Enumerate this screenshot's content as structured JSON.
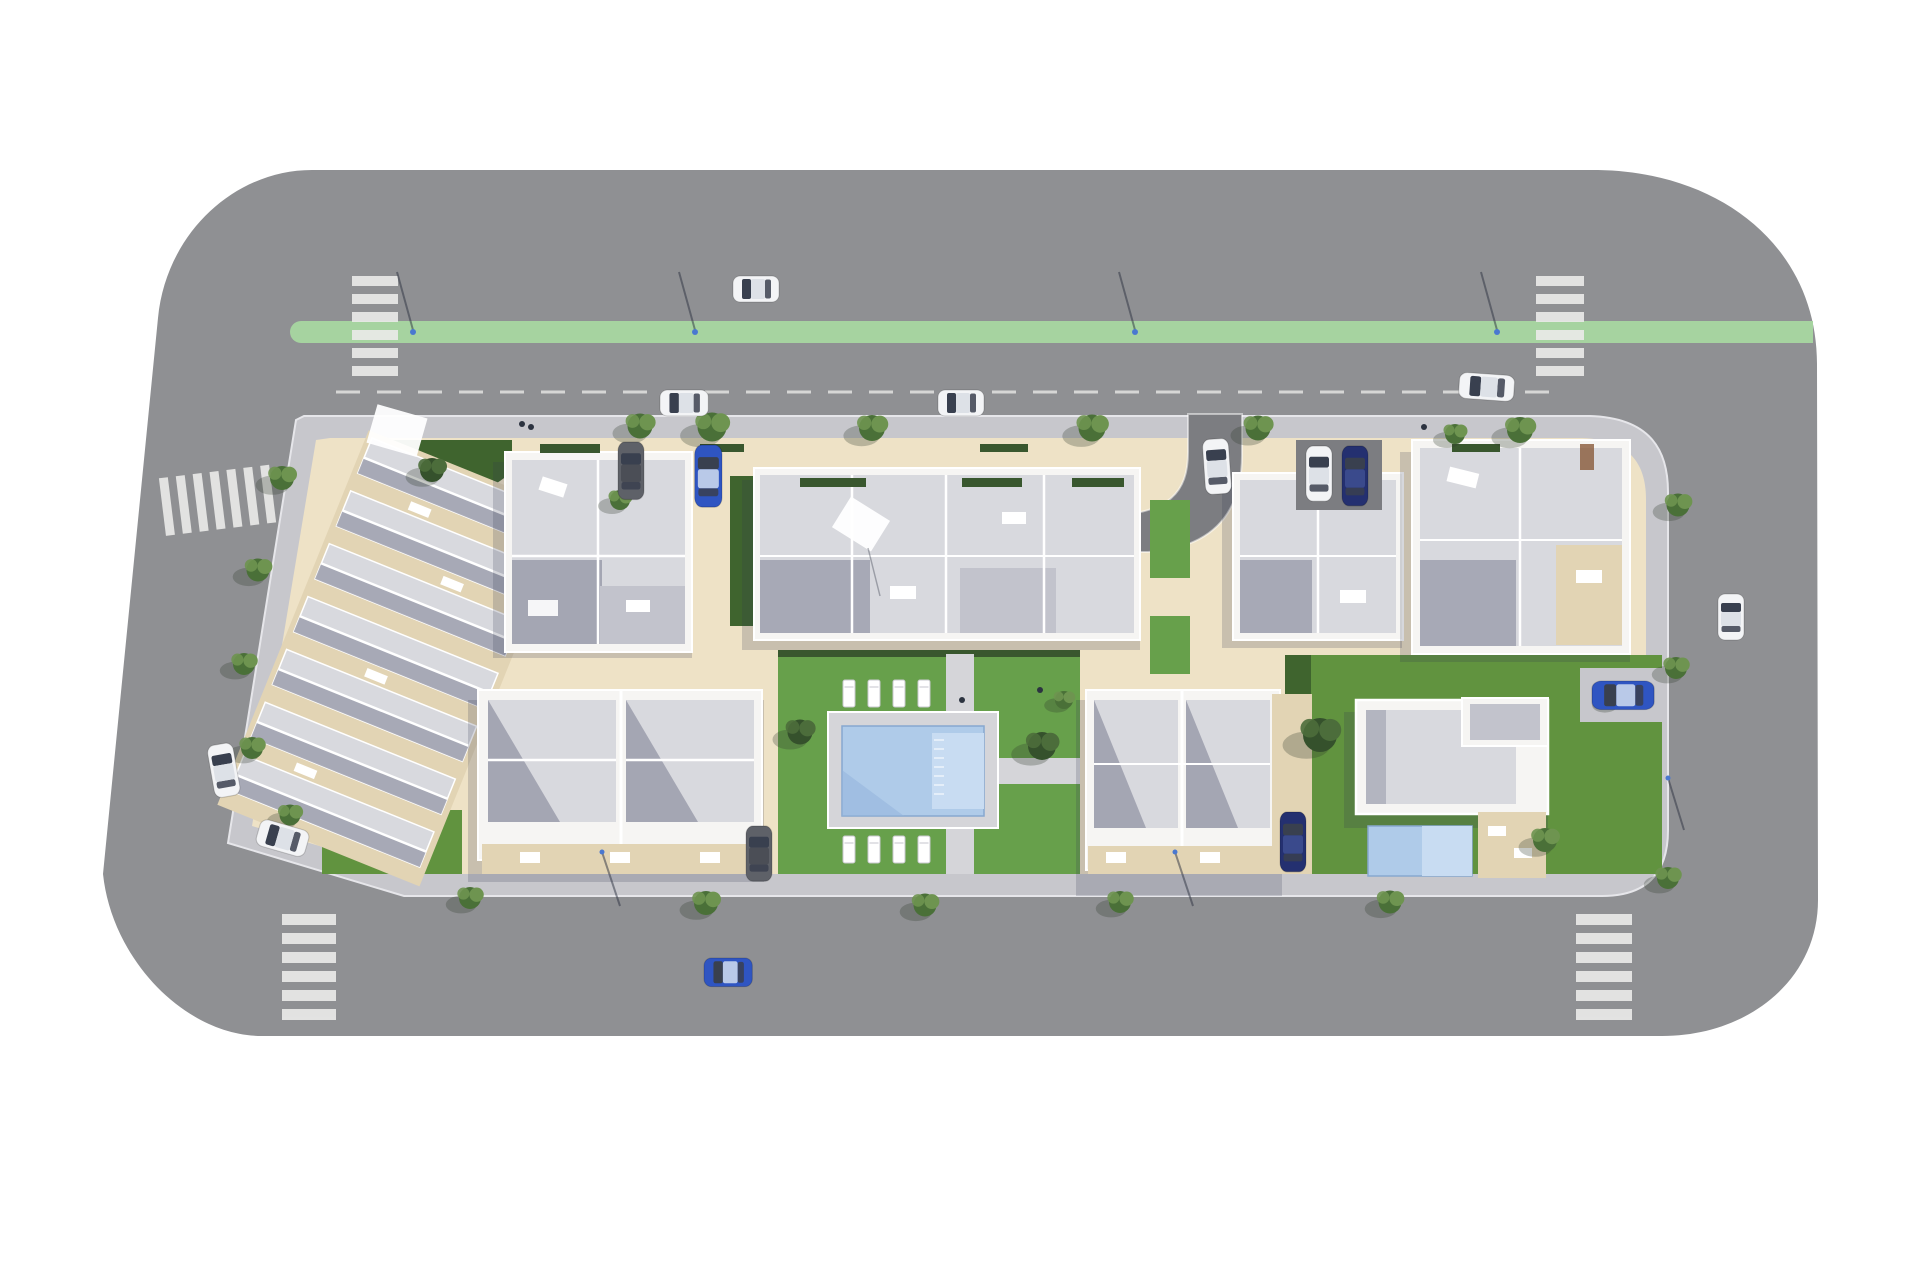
{
  "scene": {
    "description": "Aerial top-down 3D architectural render of a residential development block: white apartment buildings and townhouses with grey roof terraces around a central lawn courtyard with communal swimming pool, surrounded by asphalt streets with a green bike lane, zebra crosswalks, street trees and parked cars, on a white background",
    "view": "bird's-eye site plan",
    "background": "white"
  },
  "palette": {
    "bg": "#ffffff",
    "road": "#8f9093",
    "road_dark": "#7c7d81",
    "green_lane": "#a6d3a0",
    "crosswalk": "#eaeae8",
    "sidewalk": "#c7c7cc",
    "pavement": "#eee2c6",
    "pavement_shade": "#e2d4b4",
    "lawn": "#61933f",
    "lawn_dark": "#3f642e",
    "lawn_court": "#67a04b",
    "hedge": "#39572e",
    "roof_light": "#d8d9de",
    "roof_mid": "#c2c3cc",
    "roof_shadow": "#9b9cab",
    "wall": "#f6f5f3",
    "line": "#ffffff",
    "pool_deck": "#d5d5d9",
    "pool_water": "#afcbe9",
    "pool_water_light": "#c8dcf2",
    "pool_step": "#93b4dd",
    "tree_a": "#4a7038",
    "tree_b": "#6e9450",
    "tree_dark_a": "#35512c",
    "tree_dark_b": "#4c6d3b",
    "shadow": "rgba(52,56,78,0.20)",
    "car_white": "#f3f4f6",
    "car_white_roof": "#dde1e7",
    "car_blue": "#2f55c2",
    "car_blue_roof": "#b9c9e8",
    "car_darkblue": "#243070",
    "car_suv": "#5e6168",
    "car_glass": "#39404f",
    "lamp": "#4a78d0"
  },
  "inventory": {
    "streets": {
      "crosswalks": 5,
      "green_bike_lane": 1,
      "dashed_parking_lane_line": 1,
      "street_lamps": 8
    },
    "buildings": [
      {
        "id": "townhouse-rows",
        "label": "Rotated block of seven townhouse rows (north-west)"
      },
      {
        "id": "apartment-left",
        "label": "Apartment building with roof terraces (north, left of centre)"
      },
      {
        "id": "apartment-center",
        "label": "Large central apartment building with two wings"
      },
      {
        "id": "apartment-right",
        "label": "Apartment building east of entry driveway"
      },
      {
        "id": "apartment-corner",
        "label": "North-east corner apartment building"
      },
      {
        "id": "duplex-southwest",
        "label": "Two-unit duplex homes (south-west)"
      },
      {
        "id": "duplex-south",
        "label": "Two-unit duplex homes south of courtyard"
      },
      {
        "id": "villa",
        "label": "Modern flat-roof villa with private pool (south-east)"
      }
    ],
    "amenities": {
      "communal_pool": 1,
      "villa_pool": 1,
      "sun_loungers": 8,
      "courtyard_lawn": 1
    },
    "vehicles": [
      {
        "color": "white",
        "location": "driving on north road"
      },
      {
        "color": "white",
        "location": "parked in north parking lane (west)"
      },
      {
        "color": "white",
        "location": "parked in north parking lane (centre)"
      },
      {
        "color": "white",
        "location": "parked in north parking lane (east corner)"
      },
      {
        "color": "white",
        "location": "driving on east road"
      },
      {
        "color": "white",
        "location": "parked on west street (upper)"
      },
      {
        "color": "white",
        "location": "parked on west street (lower)"
      },
      {
        "color": "blue",
        "location": "driving on south road"
      },
      {
        "color": "dark-grey SUV",
        "location": "inside block, north-west patio"
      },
      {
        "color": "blue",
        "location": "inside block, north-west patio"
      },
      {
        "color": "white SUV",
        "location": "parking bay between east buildings"
      },
      {
        "color": "dark-blue",
        "location": "parking bay between east buildings"
      },
      {
        "color": "white",
        "location": "on curved entry driveway"
      },
      {
        "color": "dark-grey SUV",
        "location": "south-west duplex driveway"
      },
      {
        "color": "dark-blue",
        "location": "south duplex driveway"
      },
      {
        "color": "blue",
        "location": "villa driveway (east)"
      }
    ],
    "vegetation": {
      "street_trees": 24,
      "courtyard_shrubs": 5,
      "roof_hedges": 6
    }
  }
}
